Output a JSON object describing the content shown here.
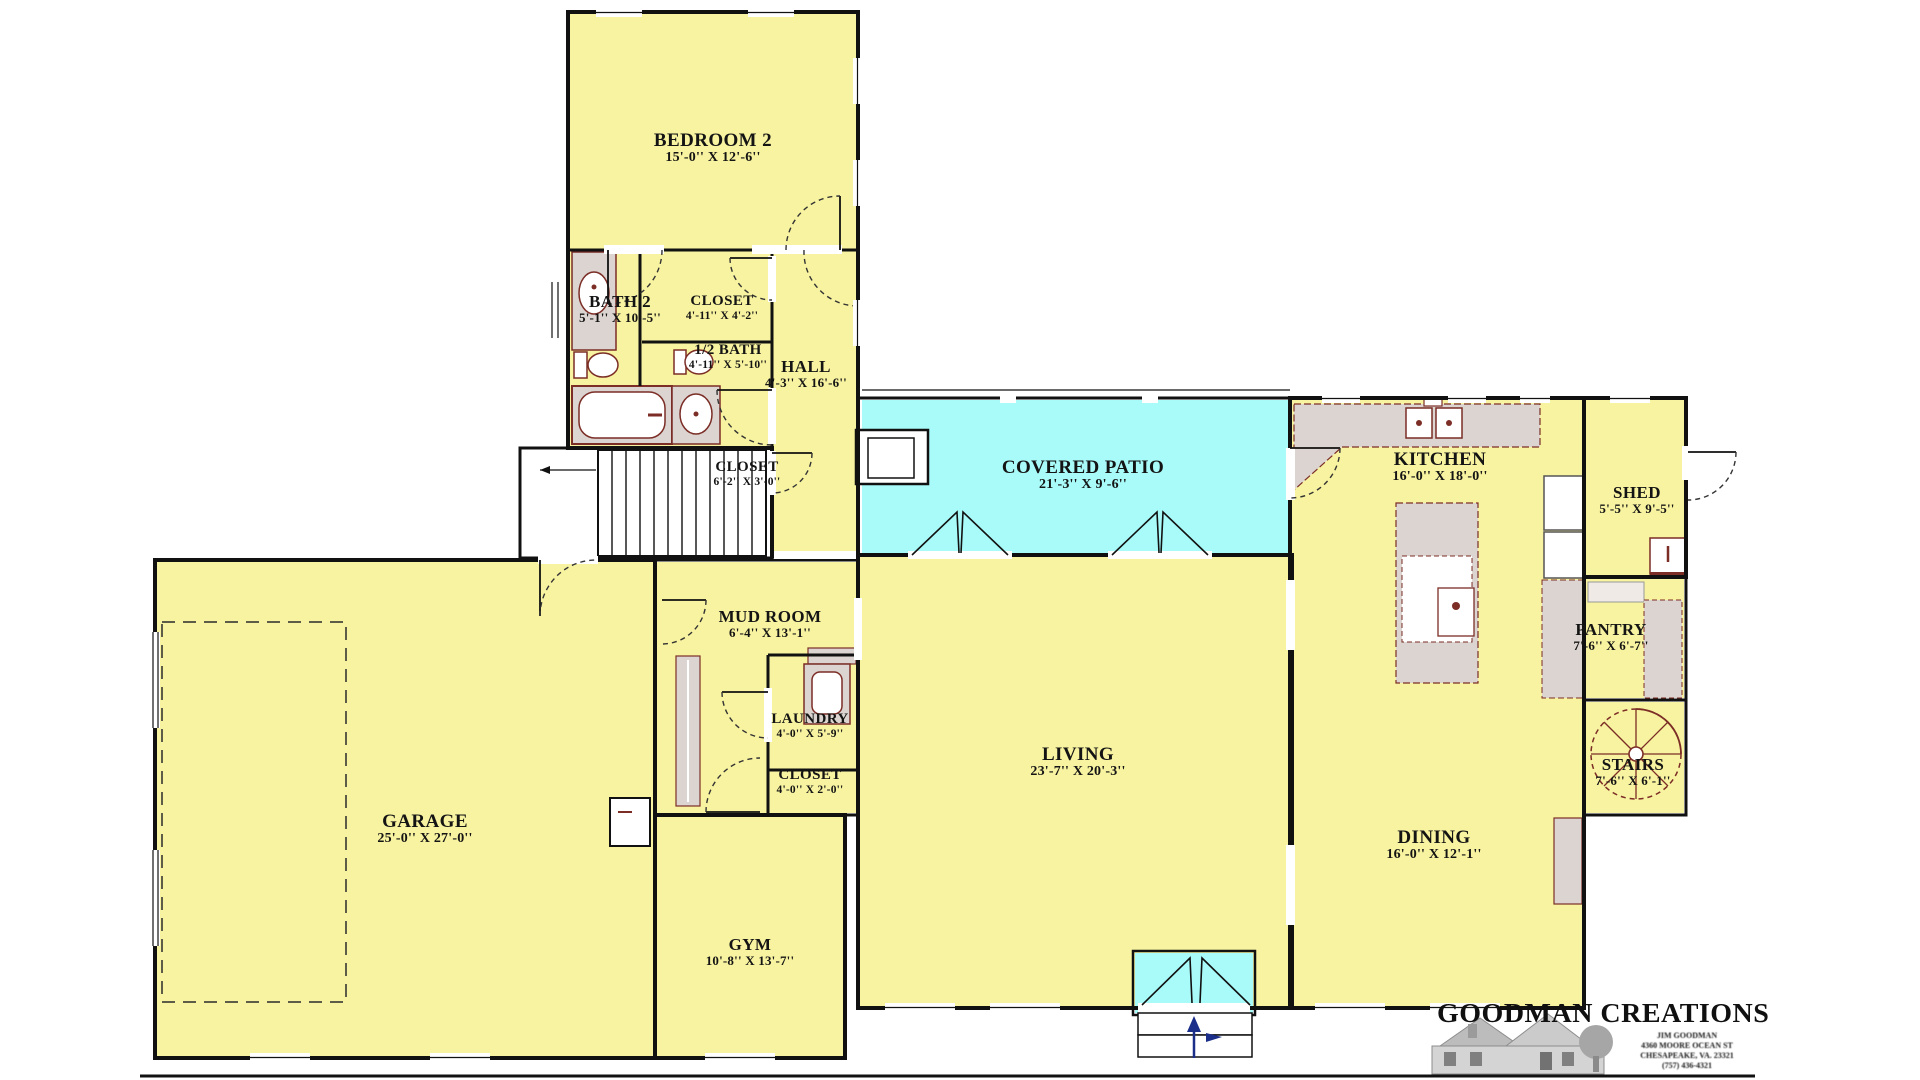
{
  "plan": {
    "rooms": {
      "bedroom2": {
        "name": "BEDROOM 2",
        "dims": "15'-0'' X 12'-6''"
      },
      "bath2": {
        "name": "BATH 2",
        "dims": "5'-1'' X 10'-5''"
      },
      "closet_bath": {
        "name": "CLOSET",
        "dims": "4'-11'' X 4'-2''"
      },
      "half_bath": {
        "name": "1/2 BATH",
        "dims": "4'-11'' X 5'-10''"
      },
      "hall": {
        "name": "HALL",
        "dims": "4'-3'' X 16'-6''"
      },
      "closet_stairs": {
        "name": "CLOSET",
        "dims": "6'-2'' X 3'-0''"
      },
      "covered_patio": {
        "name": "COVERED PATIO",
        "dims": "21'-3'' X 9'-6''"
      },
      "kitchen": {
        "name": "KITCHEN",
        "dims": "16'-0'' X 18'-0''"
      },
      "shed": {
        "name": "SHED",
        "dims": "5'-5'' X 9'-5''"
      },
      "pantry": {
        "name": "PANTRY",
        "dims": "7'-6'' X 6'-7''"
      },
      "mud_room": {
        "name": "MUD ROOM",
        "dims": "6'-4'' X 13'-1''"
      },
      "laundry": {
        "name": "LAUNDRY",
        "dims": "4'-0'' X 5'-9''"
      },
      "closet_mud": {
        "name": "CLOSET",
        "dims": "4'-0'' X 2'-0''"
      },
      "living": {
        "name": "LIVING",
        "dims": "23'-7'' X 20'-3''"
      },
      "stairs": {
        "name": "STAIRS",
        "dims": "7'-6'' X 6'-1''"
      },
      "garage": {
        "name": "GARAGE",
        "dims": "25'-0'' X 27'-0''"
      },
      "dining": {
        "name": "DINING",
        "dims": "16'-0'' X 12'-1''"
      },
      "gym": {
        "name": "GYM",
        "dims": "10'-8'' X 13'-7''"
      }
    },
    "logo": {
      "company": "GOODMAN CREATIONS",
      "address_lines": [
        "JIM GOODMAN",
        "4360 MOORE OCEAN ST",
        "CHESAPEAKE, VA. 23321",
        "(757) 436-4321"
      ]
    },
    "colors": {
      "room_fill": "#F8F3A0",
      "patio_fill": "#A9FBFA",
      "wall": "#111111",
      "fixture_outline": "#7B2D26",
      "counter_fill": "#DBD4D0",
      "north_arrow": "#1B2F8A"
    }
  }
}
